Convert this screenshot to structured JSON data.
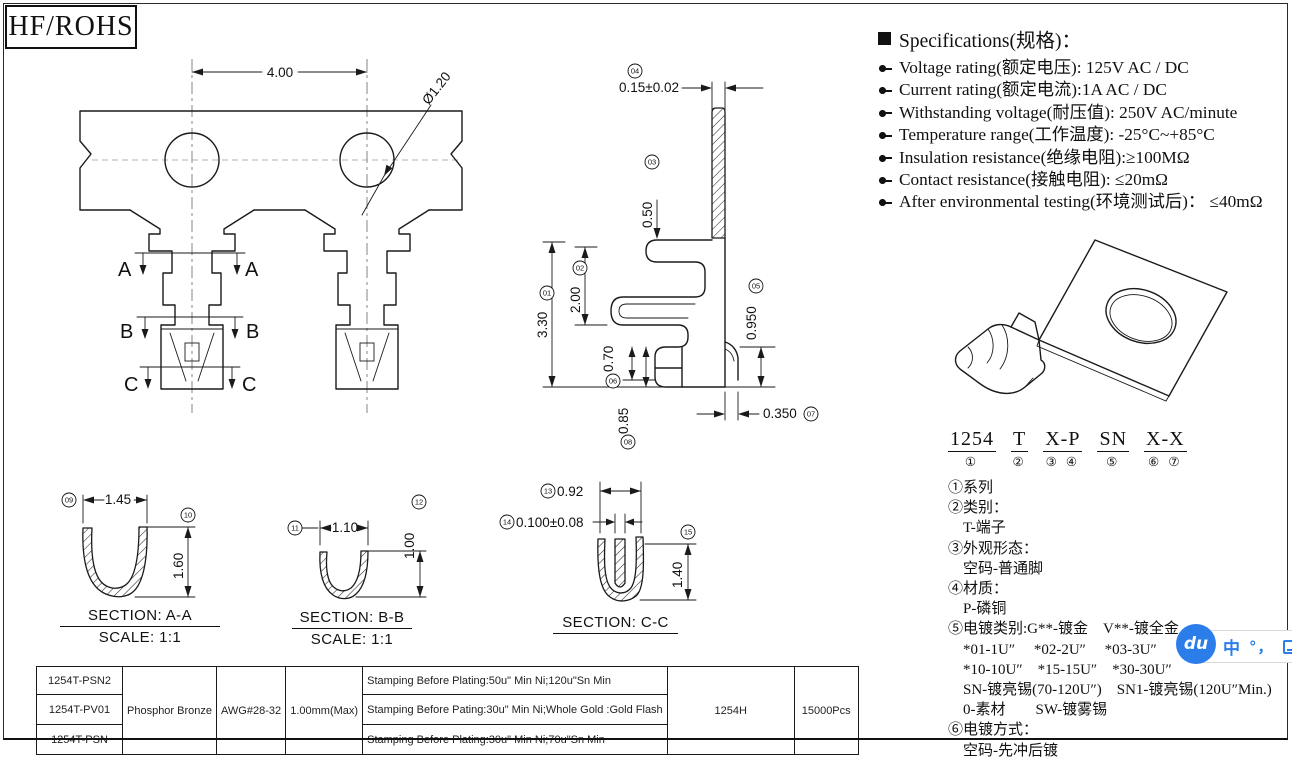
{
  "frame": {
    "title": "HF/ROHS"
  },
  "specs": {
    "heading": "Specifications(规格)：",
    "items": [
      "Voltage rating(额定电压): 125V AC / DC",
      "Current rating(额定电流):1A  AC / DC",
      "Withstanding voltage(耐压值): 250V AC/minute",
      "Temperature range(工作温度): -25°C~+85°C",
      "Insulation resistance(绝缘电阻):≥100MΩ",
      "Contact resistance(接触电阻): ≤20mΩ",
      "After environmental testing(环境测试后)： ≤40mΩ"
    ]
  },
  "front_view": {
    "pitch": "4.00",
    "hole_dia": "Ø1.20",
    "label_a": "A",
    "label_b": "B",
    "label_c": "C"
  },
  "side_view": {
    "d01": {
      "n": "01",
      "v": "3.30"
    },
    "d02": {
      "n": "02",
      "v": "2.00"
    },
    "d03": {
      "n": "03",
      "v": "0.50"
    },
    "d04": {
      "n": "04",
      "v": "0.15±0.02"
    },
    "d05": {
      "n": "05",
      "v": "0.950"
    },
    "d06": {
      "n": "06",
      "v": "0.70"
    },
    "d07": {
      "n": "07",
      "v": "0.350"
    },
    "d08": {
      "n": "08",
      "v": "0.85"
    }
  },
  "sections": {
    "aa": {
      "title": "SECTION: A-A",
      "scale": "SCALE: 1:1",
      "w": {
        "n": "09",
        "v": "1.45"
      },
      "h": {
        "n": "10",
        "v": "1.60"
      }
    },
    "bb": {
      "title": "SECTION: B-B",
      "scale": "SCALE: 1:1",
      "w": {
        "n": "11",
        "v": "1.10"
      },
      "h": {
        "n": "12",
        "v": "1.00"
      }
    },
    "cc": {
      "title": "SECTION: C-C",
      "w": {
        "n": "13",
        "v": "0.92"
      },
      "slot": {
        "n": "14",
        "v": "0.100±0.08"
      },
      "h": {
        "n": "15",
        "v": "1.40"
      }
    }
  },
  "part_number": {
    "segments": [
      {
        "code": "1254",
        "balloons": "①"
      },
      {
        "code": "T",
        "balloons": "②"
      },
      {
        "code": "X-P",
        "balloons": "③ ④"
      },
      {
        "code": "SN",
        "balloons": "⑤"
      },
      {
        "code": "X-X",
        "balloons": "⑥ ⑦"
      }
    ],
    "legend": [
      {
        "t": "①系列"
      },
      {
        "t": "②类别："
      },
      {
        "t": "T-端子"
      },
      {
        "t": "③外观形态："
      },
      {
        "t": "空码-普通脚"
      },
      {
        "t": "④材质："
      },
      {
        "t": "P-磷铜"
      },
      {
        "t": "⑤电镀类别:G**-镀金　V**-镀全金"
      },
      {
        "t": "*01-1U″　 *02-2U″　 *03-3U″"
      },
      {
        "t": "*10-10U″　*15-15U″　*30-30U″"
      },
      {
        "t": "SN-镀亮锡(70-120U″)　SN1-镀亮锡(120U″Min.)"
      },
      {
        "t": "0-素材　　SW-镀雾锡"
      },
      {
        "t": "⑥电镀方式："
      },
      {
        "t": "空码-先冲后镀"
      }
    ]
  },
  "table": {
    "material": "Phosphor Bronze",
    "wire_gauge": "AWG#28-32",
    "insulation": "1.00mm(Max)",
    "housing": "1254H",
    "packing": "15000Pcs",
    "rows": [
      {
        "part": "1254T-PSN2",
        "plating": "Stamping Before Plating:50u\" Min Ni;120u\"Sn Min"
      },
      {
        "part": "1254T-PV01",
        "plating": "Stamping Before Pating:30u\" Min Ni;Whole Gold :Gold Flash"
      },
      {
        "part": "1254T-PSN",
        "plating": "Stamping Before Plating:30u\" Min Ni;70u\"Sn Min"
      }
    ]
  },
  "watermark": {
    "logo": "du",
    "lang": "中",
    "punct": "°，",
    "color": "#2b7de9"
  }
}
